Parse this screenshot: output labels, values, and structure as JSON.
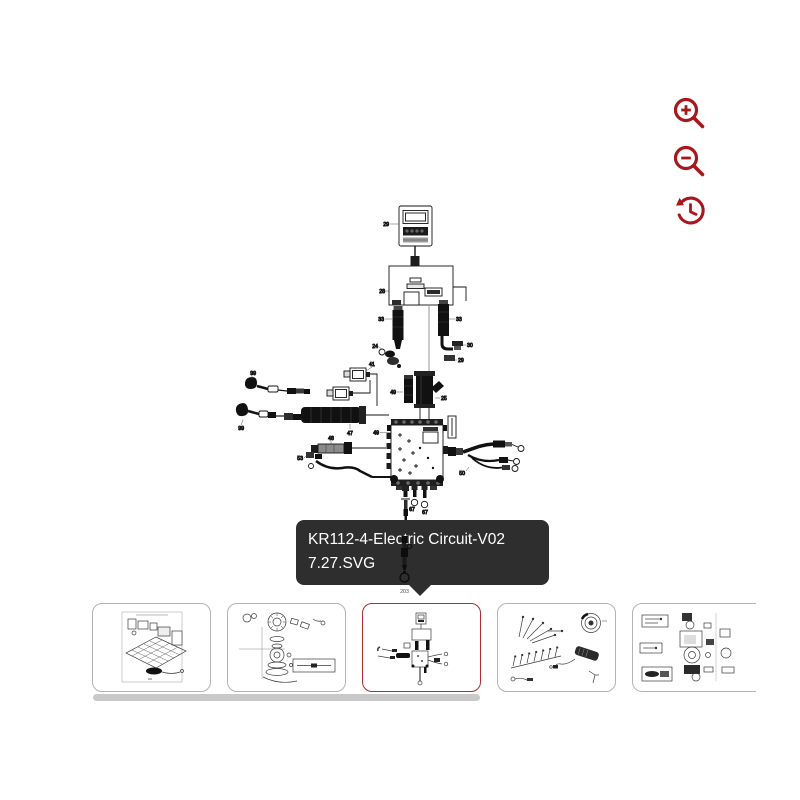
{
  "theme": {
    "accent_red": "#a6181c",
    "selected_border": "#b42a2e",
    "tooltip_bg": "#2e2e2e",
    "tooltip_text": "#ffffff",
    "card_border": "#b3b3b3",
    "scrollbar_thumb": "#c9c9c9",
    "diagram_ink": "#141414"
  },
  "controls": {
    "zoom_in_icon": "magnifier-plus",
    "zoom_out_icon": "magnifier-minus",
    "reset_icon": "history-reset"
  },
  "tooltip": {
    "line1": "KR112-4-Electric Circuit-V02",
    "line2": "7.27.SVG"
  },
  "diagram": {
    "labels": [
      "29",
      "28",
      "33",
      "33",
      "24",
      "30",
      "29",
      "41",
      "99",
      "99",
      "47",
      "49",
      "49",
      "48",
      "53",
      "25",
      "50",
      "67",
      "67"
    ],
    "overlay_label": "203"
  },
  "thumbnails": [
    {
      "id": "chassis-frame",
      "selected": false
    },
    {
      "id": "blade-deck-assembly",
      "selected": false
    },
    {
      "id": "electric-circuit",
      "selected": true
    },
    {
      "id": "fastener-kit",
      "selected": false
    },
    {
      "id": "drive-assembly",
      "selected": false
    }
  ]
}
